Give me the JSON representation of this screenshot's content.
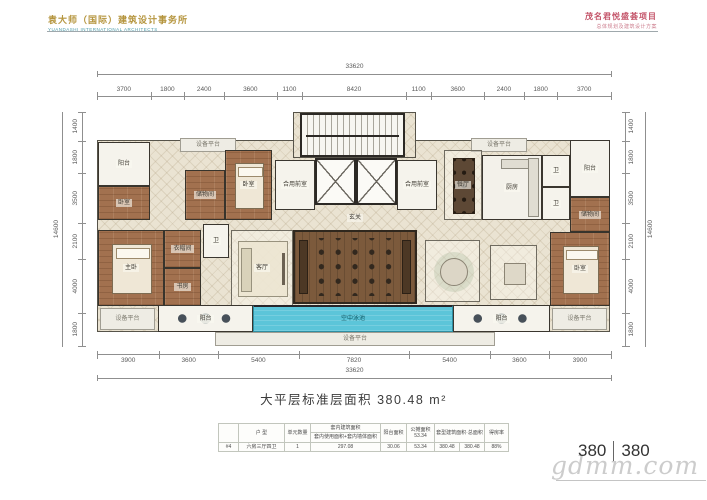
{
  "header": {
    "logo_title": "袁大师（国际）建筑设计事务所",
    "logo_subtitle": "YUANDASHI INTERNATIONAL ARCHITECTS",
    "project_title": "茂名君悦盛荟项目",
    "project_subtitle": "总体规划及建筑设计方案"
  },
  "plan": {
    "dimensions": {
      "top_total": "33620",
      "top_segments": [
        "3700",
        "1800",
        "2400",
        "3600",
        "1100",
        "8420",
        "1100",
        "3600",
        "2400",
        "1800",
        "3700"
      ],
      "bottom_segments": [
        "3900",
        "3600",
        "5400",
        "7820",
        "5400",
        "3600",
        "3900"
      ],
      "bottom_total": "33620",
      "left_segments": [
        "1400",
        "1800",
        "3500",
        "2100",
        "4000",
        "1800"
      ],
      "left_total": "14600",
      "right_segments": [
        "1400",
        "1800",
        "3500",
        "2100",
        "4000",
        "1800"
      ],
      "right_total": "14600"
    },
    "rooms": [
      {
        "name": "plan-body",
        "type": "body",
        "label": "",
        "x": 0,
        "y": 28,
        "w": 513,
        "h": 192
      },
      {
        "name": "core",
        "type": "body",
        "label": "",
        "x": 196,
        "y": 0,
        "w": 123,
        "h": 46
      },
      {
        "name": "stair-core",
        "type": "stairs",
        "label": "",
        "x": 203,
        "y": 1,
        "w": 105,
        "h": 44
      },
      {
        "name": "elevator-left",
        "type": "elevator",
        "label": "",
        "x": 218,
        "y": 46,
        "w": 41,
        "h": 47
      },
      {
        "name": "elevator-right",
        "type": "elevator",
        "label": "",
        "x": 259,
        "y": 46,
        "w": 41,
        "h": 47
      },
      {
        "name": "front-room-left",
        "type": "white",
        "label": "合用前室",
        "x": 178,
        "y": 48,
        "w": 40,
        "h": 50
      },
      {
        "name": "front-room-right",
        "type": "white",
        "label": "合用前室",
        "x": 300,
        "y": 48,
        "w": 40,
        "h": 50
      },
      {
        "name": "equip-top-left",
        "type": "platform",
        "label": "设备平台",
        "x": 83,
        "y": 26,
        "w": 56,
        "h": 14
      },
      {
        "name": "equip-top-right",
        "type": "platform",
        "label": "设备平台",
        "x": 374,
        "y": 26,
        "w": 56,
        "h": 14
      },
      {
        "name": "balcony-top-left",
        "type": "white",
        "label": "阳台",
        "x": 1,
        "y": 30,
        "w": 52,
        "h": 44
      },
      {
        "name": "bedroom-left-far",
        "type": "wood",
        "label": "卧室",
        "x": 1,
        "y": 74,
        "w": 52,
        "h": 34
      },
      {
        "name": "storage-left",
        "type": "wood",
        "label": "储物间",
        "x": 88,
        "y": 58,
        "w": 40,
        "h": 50
      },
      {
        "name": "bedroom-left",
        "type": "wood",
        "furn": "bed",
        "label": "卧室",
        "x": 128,
        "y": 38,
        "w": 47,
        "h": 70
      },
      {
        "name": "bath-left",
        "type": "white",
        "label": "卫",
        "x": 106,
        "y": 112,
        "w": 26,
        "h": 34
      },
      {
        "name": "master-left",
        "type": "wood",
        "furn": "bed",
        "label": "主卧",
        "x": 1,
        "y": 118,
        "w": 66,
        "h": 76
      },
      {
        "name": "cloak-left",
        "type": "wood",
        "label": "衣帽间",
        "x": 67,
        "y": 118,
        "w": 37,
        "h": 38
      },
      {
        "name": "study-left",
        "type": "wood",
        "label": "书房",
        "x": 67,
        "y": 156,
        "w": 37,
        "h": 38
      },
      {
        "name": "living-left",
        "type": "tile",
        "furn": "sofa",
        "label": "客厅",
        "x": 134,
        "y": 118,
        "w": 62,
        "h": 76
      },
      {
        "name": "foyer",
        "type": "open",
        "label": "玄关",
        "x": 235,
        "y": 98,
        "w": 46,
        "h": 16
      },
      {
        "name": "deck",
        "type": "deck",
        "furn": "deck-seats",
        "label": "",
        "x": 196,
        "y": 118,
        "w": 124,
        "h": 74
      },
      {
        "name": "dining-right",
        "type": "tile",
        "furn": "dining",
        "label": "餐厅",
        "x": 347,
        "y": 38,
        "w": 38,
        "h": 70
      },
      {
        "name": "kitchen-right",
        "type": "kitchen",
        "furn": "counter",
        "label": "厨房",
        "x": 385,
        "y": 43,
        "w": 60,
        "h": 65
      },
      {
        "name": "bath-right-1",
        "type": "white",
        "label": "卫",
        "x": 445,
        "y": 43,
        "w": 28,
        "h": 32
      },
      {
        "name": "bath-right-2",
        "type": "white",
        "label": "卫",
        "x": 445,
        "y": 75,
        "w": 28,
        "h": 33
      },
      {
        "name": "balcony-top-right",
        "type": "white",
        "label": "阳台",
        "x": 473,
        "y": 28,
        "w": 40,
        "h": 57
      },
      {
        "name": "storage-right",
        "type": "wood",
        "label": "储物间",
        "x": 473,
        "y": 85,
        "w": 40,
        "h": 35
      },
      {
        "name": "tea-lounge",
        "type": "tile",
        "furn": "round-table",
        "label": "",
        "x": 328,
        "y": 128,
        "w": 55,
        "h": 62
      },
      {
        "name": "game-lounge",
        "type": "tile",
        "furn": "square-table",
        "label": "",
        "x": 393,
        "y": 133,
        "w": 47,
        "h": 55
      },
      {
        "name": "master-right",
        "type": "wood",
        "furn": "bed",
        "label": "卧室",
        "x": 453,
        "y": 120,
        "w": 60,
        "h": 74
      },
      {
        "name": "equip-bottom-left",
        "type": "platform",
        "label": "设备平台",
        "x": 3,
        "y": 196,
        "w": 55,
        "h": 22
      },
      {
        "name": "balcony-bottom-left",
        "type": "white",
        "furn": "circles3",
        "label": "阳台",
        "x": 61,
        "y": 193,
        "w": 95,
        "h": 27
      },
      {
        "name": "pool",
        "type": "pool",
        "label": "空中泳池",
        "x": 156,
        "y": 193,
        "w": 200,
        "h": 27
      },
      {
        "name": "balcony-bottom-right",
        "type": "white",
        "furn": "circles3",
        "label": "阳台",
        "x": 356,
        "y": 193,
        "w": 97,
        "h": 27
      },
      {
        "name": "equip-bottom-right",
        "type": "platform",
        "label": "设备平台",
        "x": 455,
        "y": 196,
        "w": 55,
        "h": 22
      },
      {
        "name": "equip-band",
        "type": "platform",
        "label": "设备平台",
        "x": 118,
        "y": 220,
        "w": 280,
        "h": 14
      }
    ],
    "colors": {
      "logo_gold": "#b5953e",
      "logo_teal": "#4a9aa8",
      "project_red": "#c4556a",
      "pool_blue": "#5cc5d9",
      "wood_brown": "#a2714f",
      "wall_dark": "#2c2925",
      "tile_cream": "#eae3d2"
    }
  },
  "caption": "大平层标准层面积 380.48 m²",
  "table": {
    "headers": {
      "unit_type": "户 型",
      "unit_count": "单元数量",
      "interior_area": "套内建筑面积",
      "interior_area_sub": "套内使用面积+套内墙体面积",
      "balcony_area": "阳台面积",
      "shared_area": "公摊面积",
      "shared_area_value": "53.34",
      "total_area": "套型建筑面积·总面积",
      "efficiency": "得房率"
    },
    "row": {
      "id": "#4",
      "unit_type": "六房三厅四卫",
      "unit_count": "1",
      "interior_area": "297.08",
      "balcony_area": "30.06",
      "shared_area": "53.34",
      "total_area_1": "380.48",
      "total_area_2": "380.48",
      "efficiency": "88%"
    }
  },
  "page_number": {
    "left": "380",
    "right": "380"
  },
  "watermark": "gdmm.com"
}
